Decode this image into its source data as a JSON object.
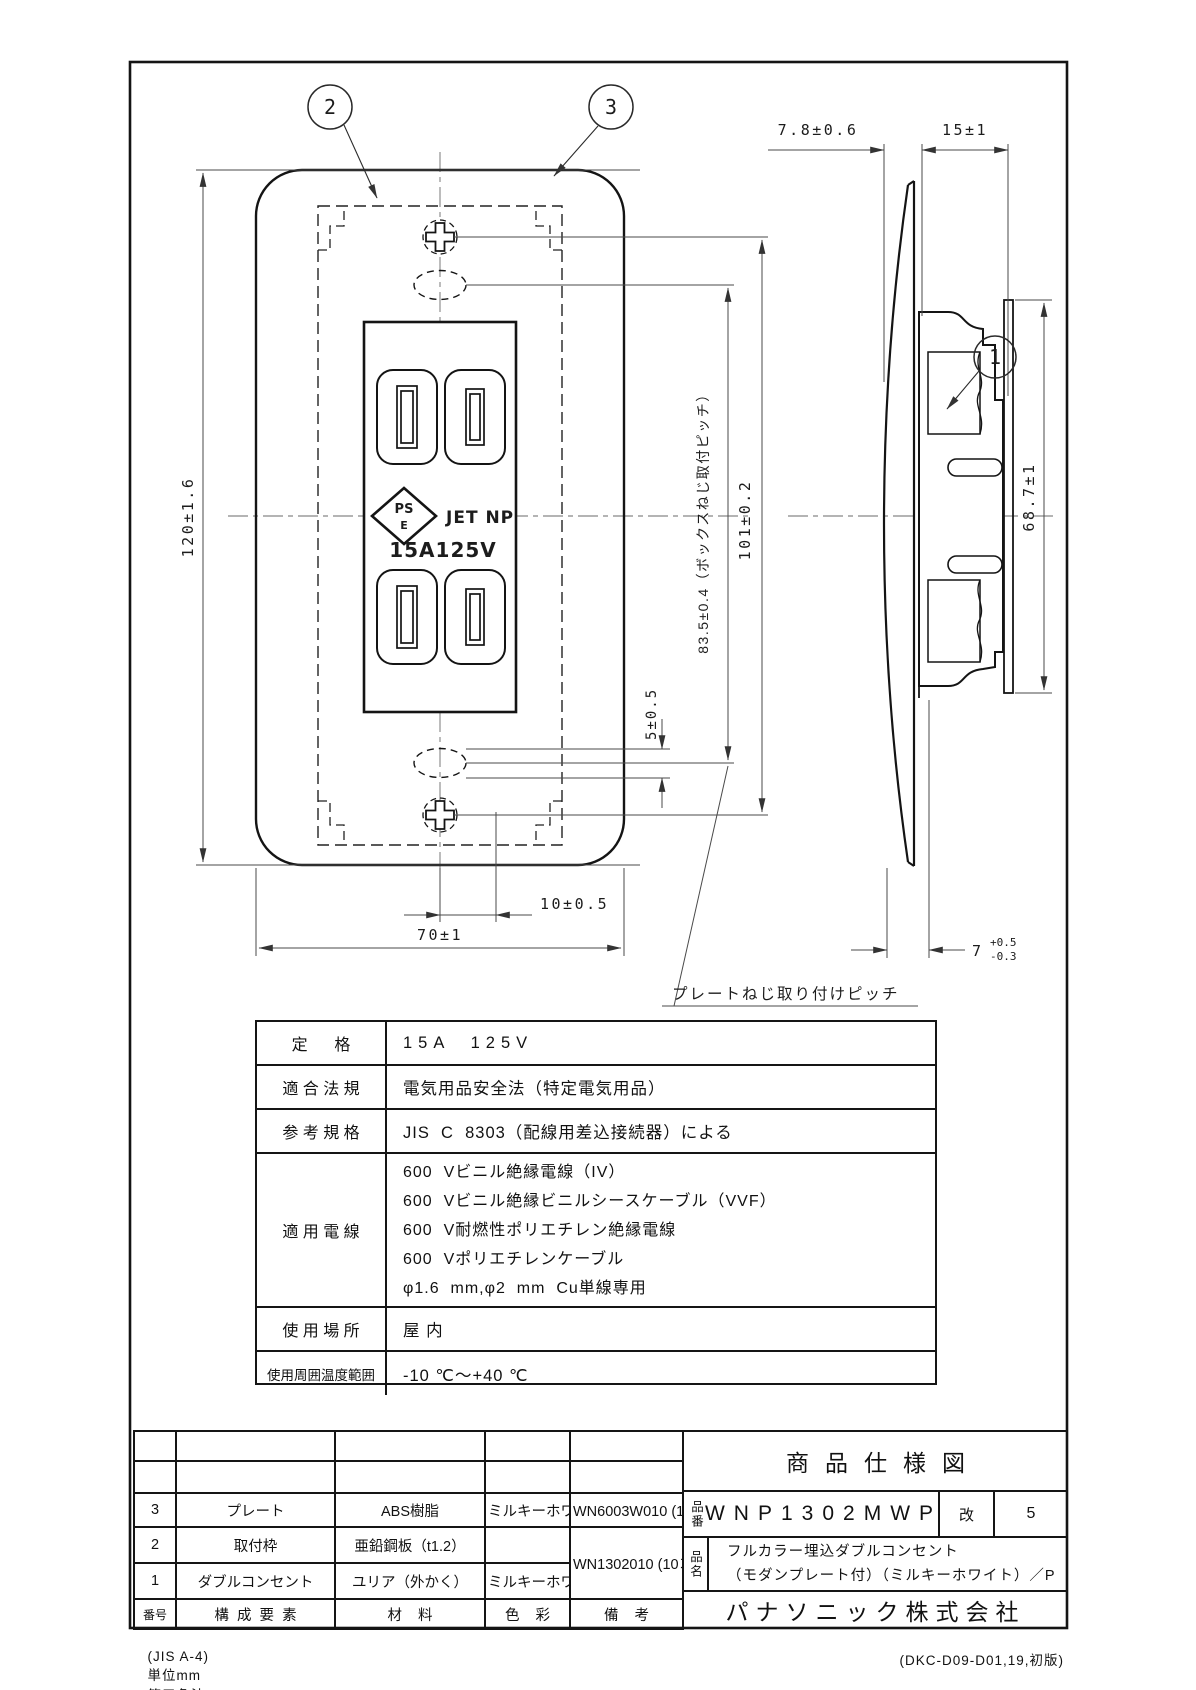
{
  "drawing": {
    "callouts": {
      "body": "1",
      "mount_frame": "2",
      "plate": "3"
    },
    "face_marks": {
      "pse_line1": "PS",
      "pse_line2": "E",
      "jet": "JET NP",
      "rating": "15A125V"
    },
    "dims": {
      "height": "120±1.6",
      "width": "70±1",
      "screw_slot_width": "10±0.5",
      "screw_slot_height": "5±0.5",
      "box_screw_pitch": "83.5±0.4（ボックスねじ取付ピッチ）",
      "plate_screw_pitch": "101±0.2",
      "plate_projection": "7.8±0.6",
      "body_depth": "15±1",
      "frame_height": "68.7±1",
      "rear_depth": "7",
      "rear_depth_tol_upper": "+0.5",
      "rear_depth_tol_lower": "-0.3",
      "plate_screw_leader": "プレートねじ取り付けピッチ"
    }
  },
  "spec_table": {
    "rows": [
      {
        "label": "定      格",
        "value": "15A  125V"
      },
      {
        "label": "適 合 法 規",
        "value": "電気用品安全法（特定電気用品）"
      },
      {
        "label": "参 考 規 格",
        "value": "JIS  C  8303（配線用差込接続器）による"
      },
      {
        "label": "適 用 電 線",
        "lines": [
          "600  Vビニル絶縁電線（IV）",
          "600  Vビニル絶縁ビニルシースケーブル（VVF）",
          "600  V耐燃性ポリエチレン絶縁電線",
          "600  Vポリエチレンケーブル",
          "φ1.6  mm,φ2  mm  Cu単線専用"
        ]
      },
      {
        "label": "使 用 場 所",
        "value": "屋 内"
      },
      {
        "label": "使用周囲温度範囲",
        "value": "-10 ℃～+40 ℃"
      }
    ]
  },
  "title_block": {
    "title": "商品仕様図",
    "part_no_label": "品番",
    "part_no": "WNP1302MWP",
    "rev_label": "改",
    "rev": "5",
    "part_name_label": "品名",
    "part_name_line1": "フルカラー埋込ダブルコンセント",
    "part_name_line2": "（モダンプレート付）（ミルキーホワイト）／P",
    "company": "パナソニック株式会社",
    "parts": {
      "headers": {
        "no": "番号",
        "component": "構  成  要  素",
        "material": "材    料",
        "color": "色    彩",
        "note": "備    考"
      },
      "rows": [
        {
          "no": "3",
          "component": "プレート",
          "material": "ABS樹脂",
          "color": "ミルキーホワイト",
          "note": "WN6003W010 (10枚入)"
        },
        {
          "no": "2",
          "component": "取付枠",
          "material": "亜鉛鋼板（t1.2）",
          "color": "",
          "note": "WN1302010 (10コ入)"
        },
        {
          "no": "1",
          "component": "ダブルコンセント",
          "material": "ユリア（外かく）",
          "color": "ミルキーホワイト",
          "note": ""
        }
      ]
    }
  },
  "footer": {
    "paper": "(JIS A-4)",
    "unit": "単位mm",
    "projection": "第三角法",
    "doc_no": "(DKC-D09-D01,19,初版)"
  }
}
